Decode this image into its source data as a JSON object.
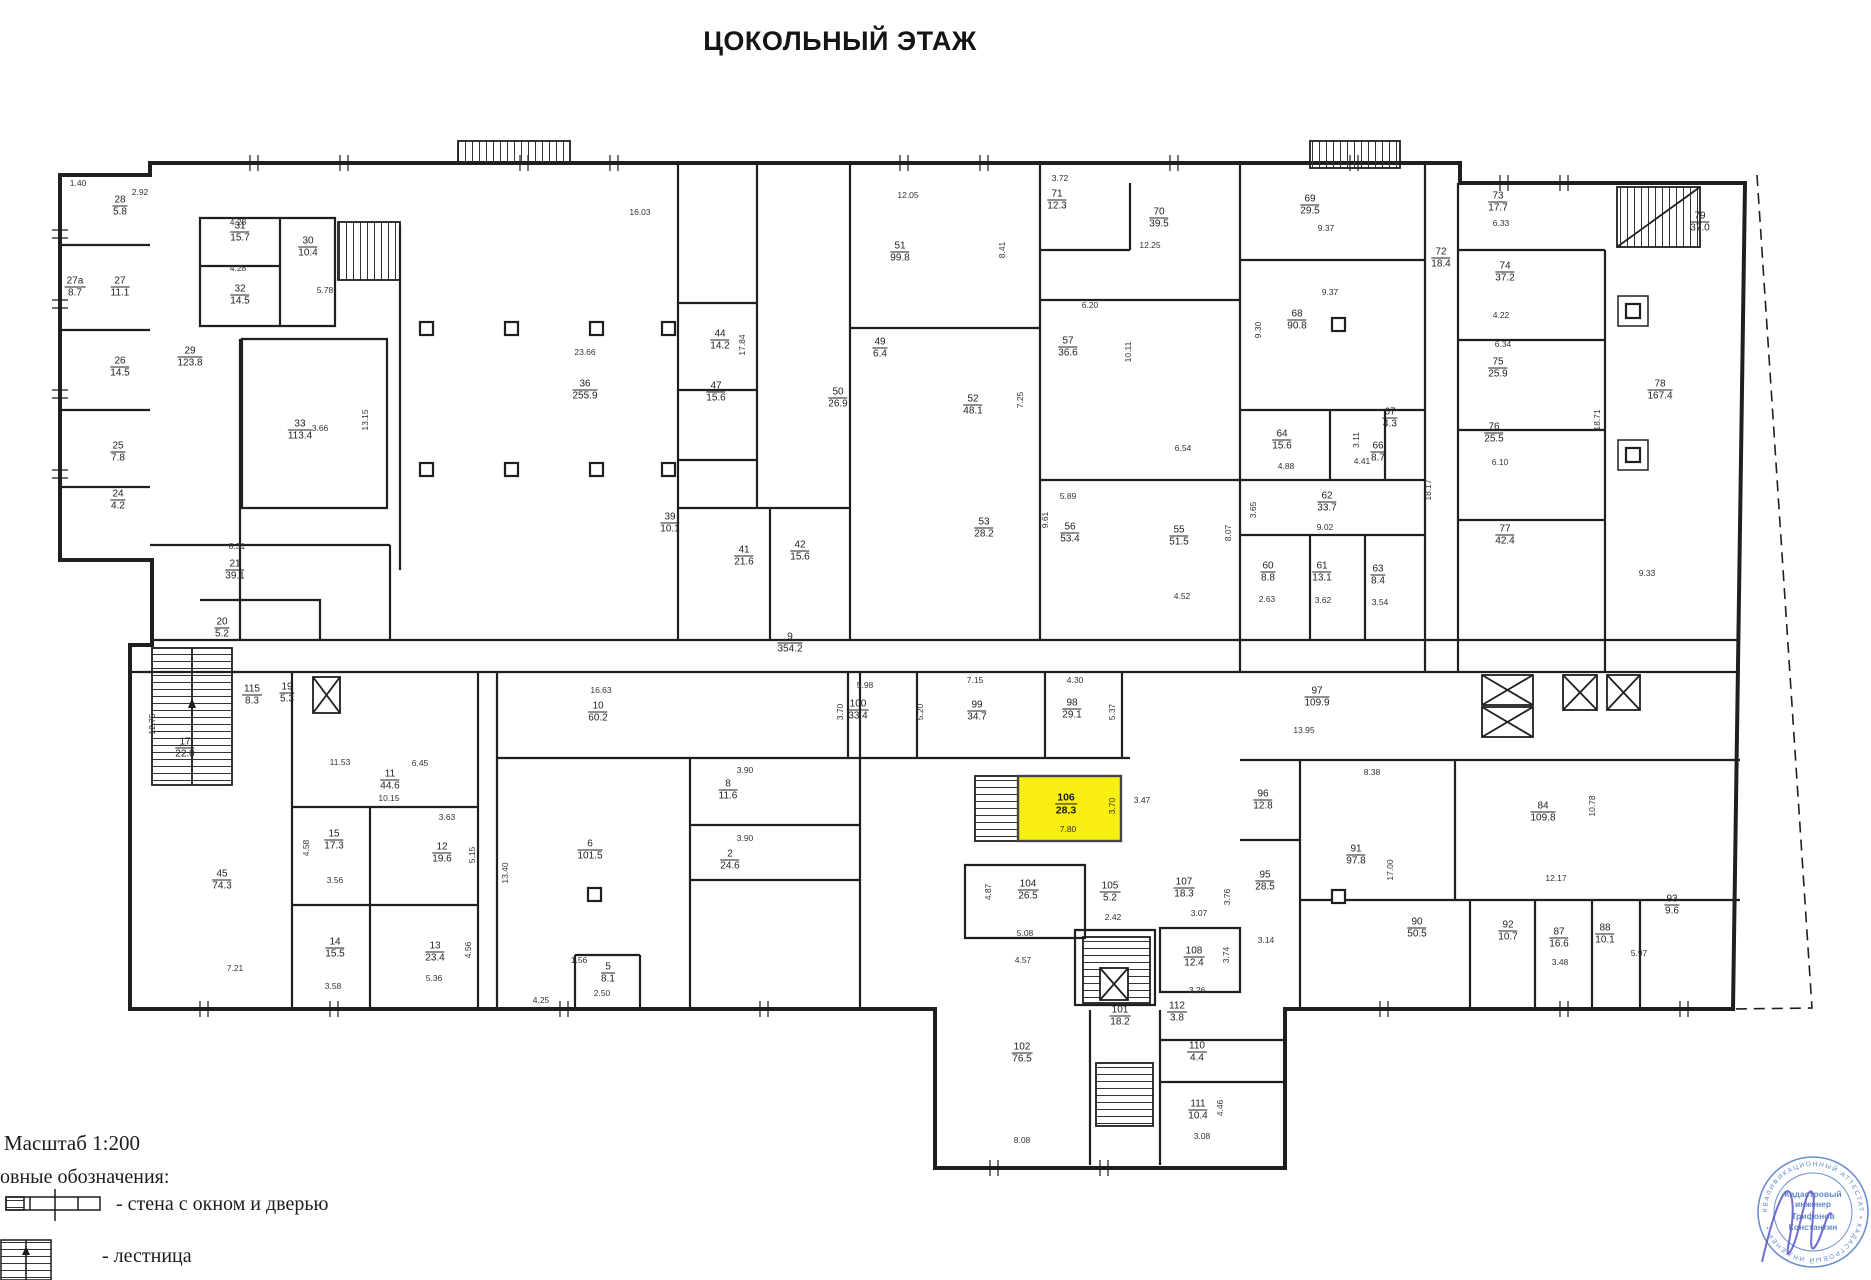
{
  "title": "ЦОКОЛЬНЫЙ ЭТАЖ",
  "colors": {
    "highlight": "#f8ee12",
    "walls": "#1f1f1f",
    "stamp_blue": "#5b83c8"
  },
  "highlight_room": {
    "number": "106",
    "area": "28.3"
  },
  "legend": {
    "scale_label": "Масштаб 1:200",
    "heading": "овные обозначения:",
    "wall_item": "- стена с окном и дверью",
    "stair_item": "- лестница"
  },
  "stamp": {
    "ring_text": "КВАЛИФИКАЦИОННЫЙ  АТТЕСТАТ  •  КАДАСТРОВЫЙ  ИНЖЕНЕР  •",
    "lines": [
      "Кадастровый",
      "инженер",
      "Трифонов",
      "Константин"
    ]
  },
  "rooms": [
    {
      "n": "28",
      "a": "5.8",
      "x": 120,
      "y": 206
    },
    {
      "n": "27",
      "a": "11.1",
      "x": 120,
      "y": 287
    },
    {
      "n": "27а",
      "a": "8.7",
      "x": 75,
      "y": 287
    },
    {
      "n": "26",
      "a": "14.5",
      "x": 120,
      "y": 367
    },
    {
      "n": "25",
      "a": "7.8",
      "x": 118,
      "y": 452
    },
    {
      "n": "24",
      "a": "4.2",
      "x": 118,
      "y": 500
    },
    {
      "n": "31",
      "a": "15.7",
      "x": 240,
      "y": 232
    },
    {
      "n": "32",
      "a": "14.5",
      "x": 240,
      "y": 295
    },
    {
      "n": "30",
      "a": "10.4",
      "x": 308,
      "y": 247
    },
    {
      "n": "33",
      "a": "113.4",
      "x": 300,
      "y": 430
    },
    {
      "n": "29",
      "a": "123.8",
      "x": 190,
      "y": 357
    },
    {
      "n": "21",
      "a": "39.1",
      "x": 235,
      "y": 570
    },
    {
      "n": "20",
      "a": "5.2",
      "x": 222,
      "y": 628
    },
    {
      "n": "17",
      "a": "22.0",
      "x": 185,
      "y": 748
    },
    {
      "n": "115",
      "a": "8.3",
      "x": 252,
      "y": 695
    },
    {
      "n": "19",
      "a": "5.3",
      "x": 287,
      "y": 693
    },
    {
      "n": "45",
      "a": "74.3",
      "x": 222,
      "y": 880
    },
    {
      "n": "36",
      "a": "255.9",
      "x": 585,
      "y": 390
    },
    {
      "n": "44",
      "a": "14.2",
      "x": 720,
      "y": 340
    },
    {
      "n": "47",
      "a": "15.6",
      "x": 716,
      "y": 392
    },
    {
      "n": "39",
      "a": "10.1",
      "x": 670,
      "y": 523
    },
    {
      "n": "41",
      "a": "21.6",
      "x": 744,
      "y": 556
    },
    {
      "n": "42",
      "a": "15.6",
      "x": 800,
      "y": 551
    },
    {
      "n": "51",
      "a": "99.8",
      "x": 900,
      "y": 252
    },
    {
      "n": "52",
      "a": "48.1",
      "x": 973,
      "y": 405
    },
    {
      "n": "50",
      "a": "26.9",
      "x": 838,
      "y": 398
    },
    {
      "n": "49",
      "a": "6.4",
      "x": 880,
      "y": 348
    },
    {
      "n": "71",
      "a": "12.3",
      "x": 1057,
      "y": 200
    },
    {
      "n": "70",
      "a": "39.5",
      "x": 1159,
      "y": 218
    },
    {
      "n": "57",
      "a": "36.6",
      "x": 1068,
      "y": 347
    },
    {
      "n": "53",
      "a": "28.2",
      "x": 984,
      "y": 528
    },
    {
      "n": "56",
      "a": "53.4",
      "x": 1070,
      "y": 533
    },
    {
      "n": "55",
      "a": "51.5",
      "x": 1179,
      "y": 536
    },
    {
      "n": "69",
      "a": "29.5",
      "x": 1310,
      "y": 205
    },
    {
      "n": "68",
      "a": "90.8",
      "x": 1297,
      "y": 320
    },
    {
      "n": "72",
      "a": "18.4",
      "x": 1441,
      "y": 258
    },
    {
      "n": "64",
      "a": "15.6",
      "x": 1282,
      "y": 440
    },
    {
      "n": "66",
      "a": "8.7",
      "x": 1378,
      "y": 452
    },
    {
      "n": "67",
      "a": "4.3",
      "x": 1390,
      "y": 418
    },
    {
      "n": "62",
      "a": "33.7",
      "x": 1327,
      "y": 502
    },
    {
      "n": "60",
      "a": "8.8",
      "x": 1268,
      "y": 572
    },
    {
      "n": "61",
      "a": "13.1",
      "x": 1322,
      "y": 572
    },
    {
      "n": "63",
      "a": "8.4",
      "x": 1378,
      "y": 575
    },
    {
      "n": "73",
      "a": "17.7",
      "x": 1498,
      "y": 202
    },
    {
      "n": "74",
      "a": "37.2",
      "x": 1505,
      "y": 272
    },
    {
      "n": "75",
      "a": "25.9",
      "x": 1498,
      "y": 368
    },
    {
      "n": "76",
      "a": "25.5",
      "x": 1494,
      "y": 433
    },
    {
      "n": "77",
      "a": "42.4",
      "x": 1505,
      "y": 535
    },
    {
      "n": "78",
      "a": "167.4",
      "x": 1660,
      "y": 390
    },
    {
      "n": "79",
      "a": "37.0",
      "x": 1700,
      "y": 222
    },
    {
      "n": "9",
      "a": "354.2",
      "x": 790,
      "y": 643
    },
    {
      "n": "10",
      "a": "60.2",
      "x": 598,
      "y": 712
    },
    {
      "n": "11",
      "a": "44.6",
      "x": 390,
      "y": 780
    },
    {
      "n": "15",
      "a": "17.3",
      "x": 334,
      "y": 840
    },
    {
      "n": "12",
      "a": "19.6",
      "x": 442,
      "y": 853
    },
    {
      "n": "14",
      "a": "15.5",
      "x": 335,
      "y": 948
    },
    {
      "n": "13",
      "a": "23.4",
      "x": 435,
      "y": 952
    },
    {
      "n": "6",
      "a": "101.5",
      "x": 590,
      "y": 850
    },
    {
      "n": "5",
      "a": "8.1",
      "x": 608,
      "y": 973
    },
    {
      "n": "8",
      "a": "11.6",
      "x": 728,
      "y": 790
    },
    {
      "n": "2",
      "a": "24.6",
      "x": 730,
      "y": 860
    },
    {
      "n": "100",
      "a": "33.4",
      "x": 858,
      "y": 710
    },
    {
      "n": "99",
      "a": "34.7",
      "x": 977,
      "y": 711
    },
    {
      "n": "98",
      "a": "29.1",
      "x": 1072,
      "y": 709
    },
    {
      "n": "97",
      "a": "109.9",
      "x": 1317,
      "y": 697
    },
    {
      "n": "96",
      "a": "12.8",
      "x": 1263,
      "y": 800
    },
    {
      "n": "95",
      "a": "28.5",
      "x": 1265,
      "y": 881
    },
    {
      "n": "91",
      "a": "97.8",
      "x": 1356,
      "y": 855
    },
    {
      "n": "84",
      "a": "109.8",
      "x": 1543,
      "y": 812
    },
    {
      "n": "90",
      "a": "50.5",
      "x": 1417,
      "y": 928
    },
    {
      "n": "92",
      "a": "10.7",
      "x": 1508,
      "y": 931
    },
    {
      "n": "87",
      "a": "16.6",
      "x": 1559,
      "y": 938
    },
    {
      "n": "88",
      "a": "10.1",
      "x": 1605,
      "y": 934
    },
    {
      "n": "93",
      "a": "9.6",
      "x": 1672,
      "y": 905
    },
    {
      "n": "104",
      "a": "26.5",
      "x": 1028,
      "y": 890
    },
    {
      "n": "105",
      "a": "5.2",
      "x": 1110,
      "y": 892
    },
    {
      "n": "107",
      "a": "18.3",
      "x": 1184,
      "y": 888
    },
    {
      "n": "108",
      "a": "12.4",
      "x": 1194,
      "y": 957
    },
    {
      "n": "101",
      "a": "18.2",
      "x": 1120,
      "y": 1016
    },
    {
      "n": "112",
      "a": "3.8",
      "x": 1177,
      "y": 1012
    },
    {
      "n": "110",
      "a": "4.4",
      "x": 1197,
      "y": 1052
    },
    {
      "n": "111",
      "a": "10.4",
      "x": 1198,
      "y": 1110
    },
    {
      "n": "102",
      "a": "76.5",
      "x": 1022,
      "y": 1053
    }
  ],
  "dims": [
    {
      "t": "23.66",
      "x": 585,
      "y": 352
    },
    {
      "t": "16.03",
      "x": 640,
      "y": 212
    },
    {
      "t": "17.84",
      "x": 742,
      "y": 345,
      "v": 1
    },
    {
      "t": "12.05",
      "x": 908,
      "y": 195
    },
    {
      "t": "8.41",
      "x": 1002,
      "y": 250,
      "v": 1
    },
    {
      "t": "3.72",
      "x": 1060,
      "y": 178
    },
    {
      "t": "12.25",
      "x": 1150,
      "y": 245
    },
    {
      "t": "6.20",
      "x": 1090,
      "y": 305
    },
    {
      "t": "10.11",
      "x": 1128,
      "y": 352,
      "v": 1
    },
    {
      "t": "7.25",
      "x": 1020,
      "y": 400,
      "v": 1
    },
    {
      "t": "9.37",
      "x": 1326,
      "y": 228
    },
    {
      "t": "9.37",
      "x": 1330,
      "y": 292
    },
    {
      "t": "9.30",
      "x": 1258,
      "y": 330,
      "v": 1
    },
    {
      "t": "6.33",
      "x": 1501,
      "y": 223
    },
    {
      "t": "4.22",
      "x": 1501,
      "y": 315
    },
    {
      "t": "6.34",
      "x": 1503,
      "y": 344
    },
    {
      "t": "18.71",
      "x": 1597,
      "y": 420,
      "v": 1
    },
    {
      "t": "9.33",
      "x": 1647,
      "y": 573
    },
    {
      "t": "18.17",
      "x": 1428,
      "y": 490,
      "v": 1
    },
    {
      "t": "13.15",
      "x": 365,
      "y": 420,
      "v": 1
    },
    {
      "t": "3.66",
      "x": 320,
      "y": 428
    },
    {
      "t": "5.78",
      "x": 325,
      "y": 290
    },
    {
      "t": "4.28",
      "x": 238,
      "y": 222
    },
    {
      "t": "4.28",
      "x": 238,
      "y": 268
    },
    {
      "t": "16.63",
      "x": 601,
      "y": 690
    },
    {
      "t": "11.53",
      "x": 340,
      "y": 762
    },
    {
      "t": "10.15",
      "x": 389,
      "y": 798
    },
    {
      "t": "6.45",
      "x": 420,
      "y": 763
    },
    {
      "t": "13.40",
      "x": 505,
      "y": 873,
      "v": 1
    },
    {
      "t": "12.75",
      "x": 152,
      "y": 724,
      "v": 1
    },
    {
      "t": "7.21",
      "x": 235,
      "y": 968
    },
    {
      "t": "8.31",
      "x": 237,
      "y": 546
    },
    {
      "t": "5.98",
      "x": 865,
      "y": 685
    },
    {
      "t": "7.15",
      "x": 975,
      "y": 680
    },
    {
      "t": "4.30",
      "x": 1075,
      "y": 680
    },
    {
      "t": "5.20",
      "x": 920,
      "y": 712,
      "v": 1
    },
    {
      "t": "5.37",
      "x": 1112,
      "y": 712,
      "v": 1
    },
    {
      "t": "3.70",
      "x": 840,
      "y": 712,
      "v": 1
    },
    {
      "t": "13.95",
      "x": 1304,
      "y": 730
    },
    {
      "t": "8.38",
      "x": 1372,
      "y": 772
    },
    {
      "t": "17.00",
      "x": 1390,
      "y": 870,
      "v": 1
    },
    {
      "t": "12.17",
      "x": 1556,
      "y": 878
    },
    {
      "t": "10.78",
      "x": 1592,
      "y": 806,
      "v": 1
    },
    {
      "t": "8.08",
      "x": 1022,
      "y": 1140
    },
    {
      "t": "3.08",
      "x": 1202,
      "y": 1136
    },
    {
      "t": "4.46",
      "x": 1220,
      "y": 1108,
      "v": 1
    },
    {
      "t": "3.26",
      "x": 1197,
      "y": 990
    },
    {
      "t": "3.14",
      "x": 1266,
      "y": 940
    },
    {
      "t": "4.57",
      "x": 1023,
      "y": 960
    },
    {
      "t": "5.08",
      "x": 1025,
      "y": 933
    },
    {
      "t": "3.90",
      "x": 745,
      "y": 770
    },
    {
      "t": "3.90",
      "x": 745,
      "y": 838
    },
    {
      "t": "3.63",
      "x": 447,
      "y": 817
    },
    {
      "t": "5.15",
      "x": 472,
      "y": 855,
      "v": 1
    },
    {
      "t": "3.58",
      "x": 333,
      "y": 986
    },
    {
      "t": "5.36",
      "x": 434,
      "y": 978
    },
    {
      "t": "4.56",
      "x": 468,
      "y": 950,
      "v": 1
    },
    {
      "t": "4.58",
      "x": 306,
      "y": 848,
      "v": 1
    },
    {
      "t": "3.56",
      "x": 335,
      "y": 880
    },
    {
      "t": "1.56",
      "x": 579,
      "y": 960
    },
    {
      "t": "2.50",
      "x": 602,
      "y": 993
    },
    {
      "t": "4.25",
      "x": 541,
      "y": 1000
    },
    {
      "t": "7.80",
      "x": 1068,
      "y": 829
    },
    {
      "t": "3.70",
      "x": 1112,
      "y": 806,
      "v": 1
    },
    {
      "t": "3.47",
      "x": 1142,
      "y": 800
    },
    {
      "t": "6.54",
      "x": 1183,
      "y": 448
    },
    {
      "t": "5.89",
      "x": 1068,
      "y": 496
    },
    {
      "t": "9.61",
      "x": 1045,
      "y": 520,
      "v": 1
    },
    {
      "t": "8.07",
      "x": 1228,
      "y": 533,
      "v": 1
    },
    {
      "t": "4.52",
      "x": 1182,
      "y": 596
    },
    {
      "t": "9.02",
      "x": 1325,
      "y": 527
    },
    {
      "t": "3.65",
      "x": 1253,
      "y": 510,
      "v": 1
    },
    {
      "t": "4.88",
      "x": 1286,
      "y": 466
    },
    {
      "t": "4.41",
      "x": 1362,
      "y": 461
    },
    {
      "t": "3.11",
      "x": 1356,
      "y": 440,
      "v": 1
    },
    {
      "t": "2.63",
      "x": 1267,
      "y": 599
    },
    {
      "t": "3.62",
      "x": 1323,
      "y": 600
    },
    {
      "t": "3.54",
      "x": 1380,
      "y": 602
    },
    {
      "t": "4.87",
      "x": 988,
      "y": 892,
      "v": 1
    },
    {
      "t": "2.42",
      "x": 1113,
      "y": 917
    },
    {
      "t": "3.07",
      "x": 1199,
      "y": 913
    },
    {
      "t": "3.76",
      "x": 1227,
      "y": 897,
      "v": 1
    },
    {
      "t": "3.74",
      "x": 1226,
      "y": 955,
      "v": 1
    },
    {
      "t": "5.97",
      "x": 1639,
      "y": 953
    },
    {
      "t": "3.48",
      "x": 1560,
      "y": 962
    },
    {
      "t": "6.10",
      "x": 1500,
      "y": 462
    },
    {
      "t": "2.92",
      "x": 140,
      "y": 192
    },
    {
      "t": "1.40",
      "x": 78,
      "y": 183
    }
  ]
}
